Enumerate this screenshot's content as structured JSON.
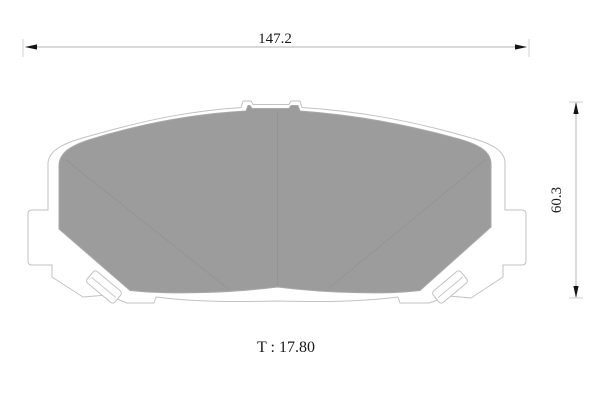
{
  "dimensions": {
    "width": "147.2",
    "height": "60.3",
    "thickness": "T : 17.80"
  },
  "colors": {
    "background": "#ffffff",
    "pad_fill": "#9c9c9c",
    "plate_outline": "#c2c2c2",
    "dimension_line": "#b3b3b3",
    "arrow": "#141414",
    "text": "#1a1a1a"
  }
}
